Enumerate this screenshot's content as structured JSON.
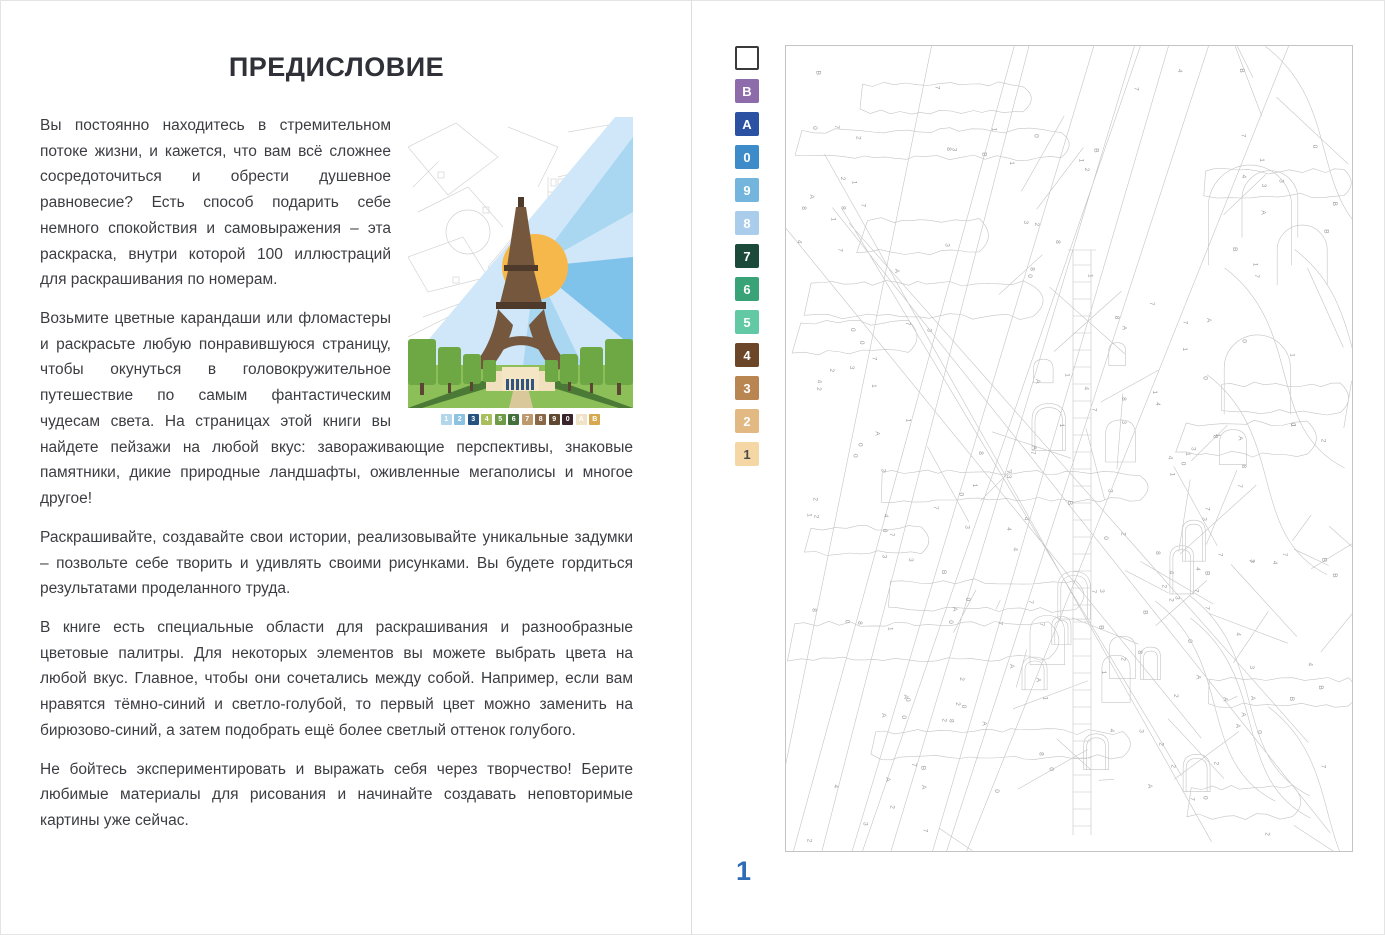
{
  "left_page": {
    "title": "ПРЕДИСЛОВИЕ",
    "paragraphs": [
      "Вы постоянно находитесь в стремительном потоке жизни, и кажется, что вам всё сложнее сосредоточиться и обрести душевное равновесие? Есть способ подарить себе немного спокойствия и самовыражения – эта раскраска, внутри которой 100 иллюстраций для раскрашивания по номерам.",
      "Возьмите цветные карандаши или фломастеры и раскрасьте любую понравившуюся страницу, чтобы окунуться в головокружительное путешествие по самым фантастическим чудесам света. На страницах этой книги вы найдете пейзажи на любой вкус: завораживающие перспективы, знаковые памятники, дикие природные ландшафты, оживленные мегаполисы и многое другое!",
      "Раскрашивайте, создавайте свои истории, реализовывайте уникальные задумки – позвольте себе творить и удивлять своими рисунками. Вы будете гордиться результатами проделанного труда.",
      "В книге есть специальные области для раскрашивания и разнообразные цветовые палитры. Для некоторых элементов вы можете выбрать цвета на любой вкус. Главное, чтобы они сочетались между собой. Например, если вам нравятся тёмно-синий и светло-голубой, то первый цвет можно заменить на бирюзово-синий, а затем подобрать ещё более светлый оттенок голубого.",
      "Не бойтесь экспериментировать и выражать себя через творчество! Берите любимые материалы для рисования и начинайте создавать неповторимые картины уже сейчас."
    ],
    "mini_palette": [
      {
        "label": "1",
        "color": "#b3d6ea",
        "text": "#ffffff"
      },
      {
        "label": "2",
        "color": "#8cc3e3",
        "text": "#ffffff"
      },
      {
        "label": "3",
        "color": "#25527f",
        "text": "#ffffff"
      },
      {
        "label": "4",
        "color": "#a9bf5e",
        "text": "#ffffff"
      },
      {
        "label": "5",
        "color": "#6e9b45",
        "text": "#ffffff"
      },
      {
        "label": "6",
        "color": "#44703c",
        "text": "#ffffff"
      },
      {
        "label": "7",
        "color": "#bd9a6d",
        "text": "#ffffff"
      },
      {
        "label": "8",
        "color": "#8a6847",
        "text": "#ffffff"
      },
      {
        "label": "9",
        "color": "#5f4730",
        "text": "#ffffff"
      },
      {
        "label": "0",
        "color": "#3a242b",
        "text": "#ffffff"
      },
      {
        "label": "А",
        "color": "#efe2c6",
        "text": "#ffffff"
      },
      {
        "label": "В",
        "color": "#d8a84e",
        "text": "#ffffff"
      }
    ]
  },
  "right_page": {
    "page_number": "1",
    "palette": [
      {
        "label": "",
        "color": "#ffffff",
        "text": "#000000",
        "border": "#3a3a3a"
      },
      {
        "label": "В",
        "color": "#8e6cab",
        "text": "#ffffff"
      },
      {
        "label": "А",
        "color": "#2b51a3",
        "text": "#ffffff"
      },
      {
        "label": "0",
        "color": "#3d8cc9",
        "text": "#ffffff"
      },
      {
        "label": "9",
        "color": "#74b5de",
        "text": "#ffffff"
      },
      {
        "label": "8",
        "color": "#a9cdea",
        "text": "#ffffff"
      },
      {
        "label": "7",
        "color": "#1b4a3a",
        "text": "#ffffff"
      },
      {
        "label": "6",
        "color": "#39a377",
        "text": "#ffffff"
      },
      {
        "label": "5",
        "color": "#63c9a5",
        "text": "#ffffff"
      },
      {
        "label": "4",
        "color": "#6b4628",
        "text": "#ffffff"
      },
      {
        "label": "3",
        "color": "#b98551",
        "text": "#ffffff"
      },
      {
        "label": "2",
        "color": "#e2b983",
        "text": "#ffffff"
      },
      {
        "label": "1",
        "color": "#f5d7a5",
        "text": "#4a4a4a"
      }
    ],
    "drawing": {
      "symbols": [
        "1",
        "2",
        "3",
        "4",
        "7",
        "8",
        "0",
        "А",
        "В"
      ],
      "stroke": "#c4c4c4",
      "label_color": "#9b9b9b"
    }
  }
}
